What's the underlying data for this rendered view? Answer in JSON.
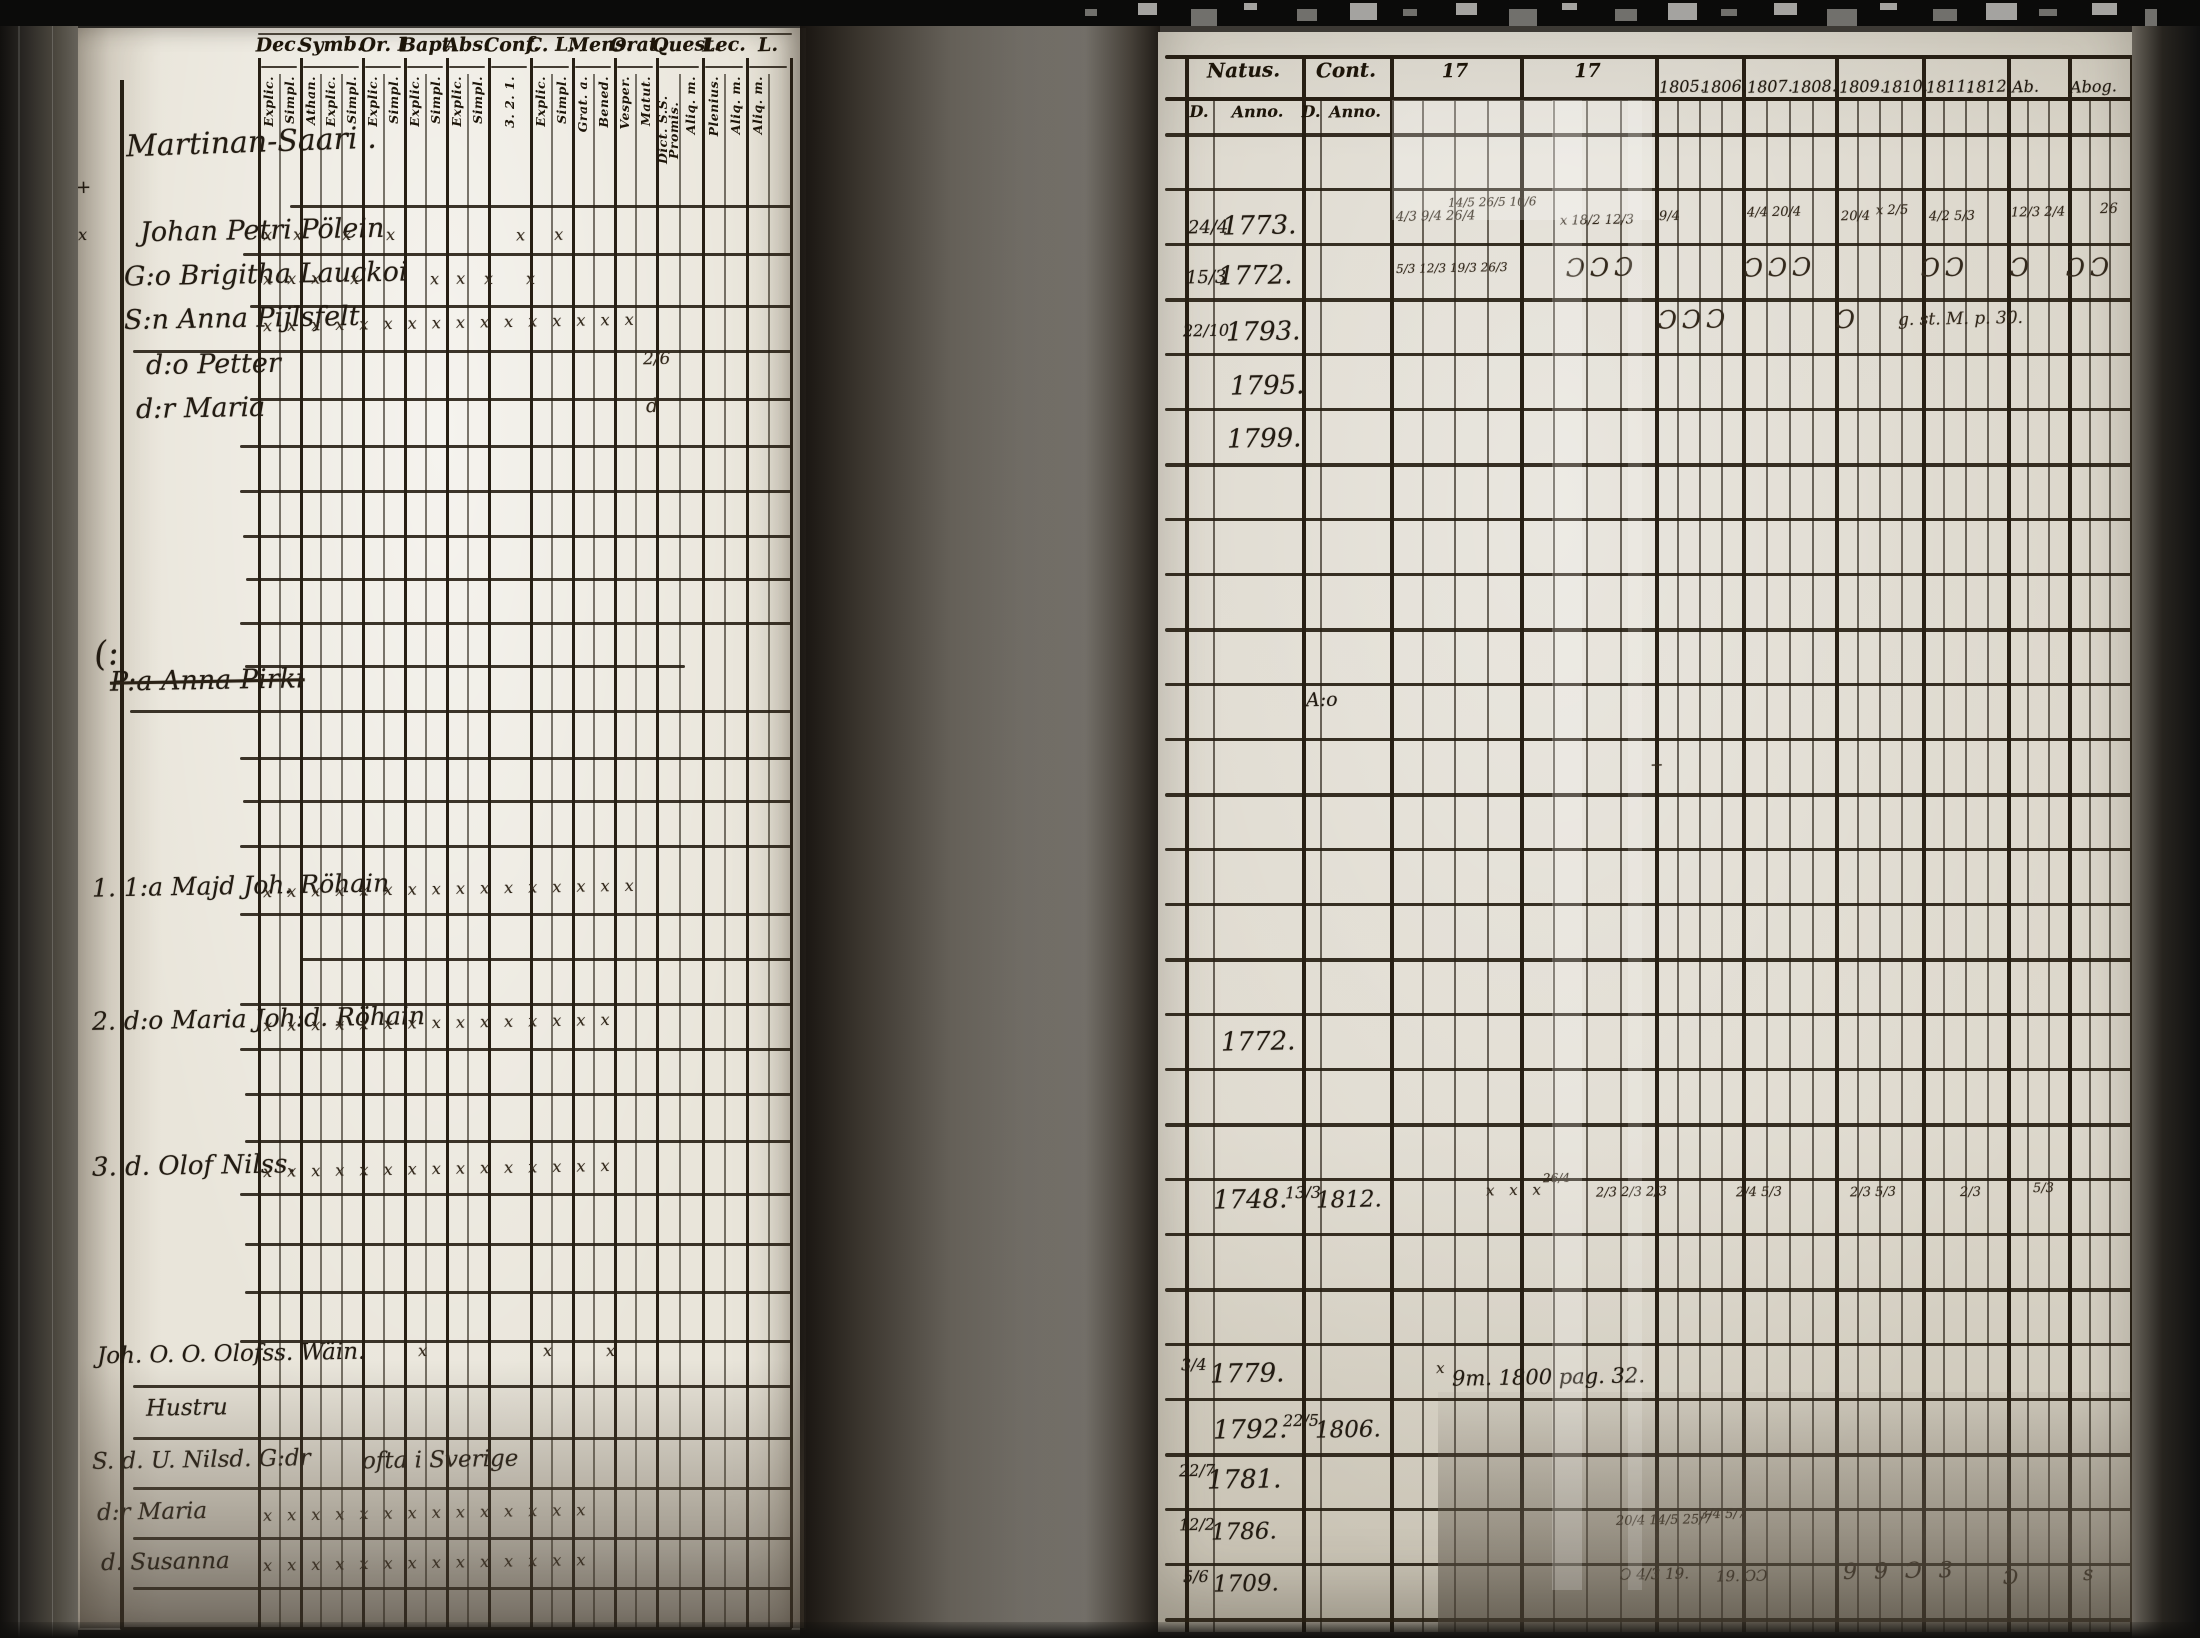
{
  "page_number": "72",
  "left_page": {
    "section_title": "Martinan-Saari .",
    "header_groups": [
      {
        "label": "Dec.",
        "subs": [
          "Explic.",
          "Simpl."
        ]
      },
      {
        "label": "Symb.",
        "subs": [
          "Athan.",
          "Explic.",
          "Simpl."
        ]
      },
      {
        "label": "Or. I",
        "subs": [
          "Explic.",
          "Simpl."
        ]
      },
      {
        "label": "Bapt.",
        "subs": [
          "Explic.",
          "Simpl."
        ]
      },
      {
        "label": "Abs.",
        "subs": [
          "Explic.",
          "Simpl."
        ]
      },
      {
        "label": "Conf.",
        "subs": [
          "3. 2. 1."
        ]
      },
      {
        "label": "C. L.",
        "subs": [
          "Explic.",
          "Simpl."
        ]
      },
      {
        "label": "Mens.",
        "subs": [
          "Grat. a.",
          "Bened."
        ]
      },
      {
        "label": "Orat.",
        "subs": [
          "Vesper.",
          "Matut."
        ]
      },
      {
        "label": "Quest.",
        "subs": [
          "Dict. S.S. Promis.",
          "Aliq. m."
        ]
      },
      {
        "label": "Lec.",
        "subs": [
          "Plenius.",
          "Aliq. m."
        ]
      },
      {
        "label": "L.",
        "subs": [
          "Aliq. m.",
          ""
        ]
      }
    ],
    "entries": [
      {
        "x": 140,
        "y": 216,
        "t": "Johan Petri Pölein",
        "fs": 27
      },
      {
        "x": 124,
        "y": 260,
        "t": "G:o Brigitha Lauckoi",
        "fs": 27
      },
      {
        "x": 124,
        "y": 304,
        "t": "S:n Anna Pijlsfelt",
        "fs": 27
      },
      {
        "x": 146,
        "y": 350,
        "t": "d:o Petter",
        "fs": 27
      },
      {
        "x": 136,
        "y": 394,
        "t": "d:r Maria",
        "fs": 27
      },
      {
        "x": 94,
        "y": 636,
        "t": "(:",
        "fs": 34,
        "r": -6
      },
      {
        "x": 110,
        "y": 666,
        "t": "P:a Anna Pirki",
        "fs": 27,
        "strike": true
      },
      {
        "x": 92,
        "y": 872,
        "t": "1. 1:a Majd Joh. Röhain",
        "fs": 25
      },
      {
        "x": 92,
        "y": 1005,
        "t": "2. d:o Maria Joh:d. Röhain",
        "fs": 25
      },
      {
        "x": 92,
        "y": 1152,
        "t": "3. d. Olof Nilss.",
        "fs": 26
      },
      {
        "x": 97,
        "y": 1342,
        "t": "Joh. O. O. Olofss. Wäin.",
        "fs": 23
      },
      {
        "x": 146,
        "y": 1396,
        "t": "Hustru",
        "fs": 23
      },
      {
        "x": 92,
        "y": 1448,
        "t": "S. d. U. Nilsd. G:dr",
        "fs": 23
      },
      {
        "x": 362,
        "y": 1448,
        "t": "ofta i Sverige",
        "fs": 23
      },
      {
        "x": 97,
        "y": 1500,
        "t": "d:r Maria",
        "fs": 23
      },
      {
        "x": 101,
        "y": 1550,
        "t": "d. Susanna",
        "fs": 23
      },
      {
        "x": 76,
        "y": 178,
        "t": "+",
        "fs": 18
      },
      {
        "x": 78,
        "y": 226,
        "t": "x",
        "fs": 16
      }
    ],
    "marks": [
      {
        "x": 263,
        "y": 226,
        "t": "x x",
        "ls": 8
      },
      {
        "x": 342,
        "y": 226,
        "t": "x"
      },
      {
        "x": 386,
        "y": 226,
        "t": "x"
      },
      {
        "x": 516,
        "y": 226,
        "t": "x x",
        "ls": 12
      },
      {
        "x": 263,
        "y": 270,
        "t": "x x x",
        "ls": 5
      },
      {
        "x": 350,
        "y": 270,
        "t": "x"
      },
      {
        "x": 430,
        "y": 270,
        "t": "x x",
        "ls": 6
      },
      {
        "x": 484,
        "y": 270,
        "t": "x"
      },
      {
        "x": 526,
        "y": 270,
        "t": "x"
      },
      {
        "x": 263,
        "y": 314,
        "t": "x x x x x x x x x x x x x x x x",
        "ls": 5
      },
      {
        "x": 643,
        "y": 350,
        "t": "2/6",
        "fs": 17
      },
      {
        "x": 646,
        "y": 396,
        "t": "d",
        "fs": 19
      },
      {
        "x": 263,
        "y": 880,
        "t": "x x x x x x x x x x x x x x x x",
        "ls": 5
      },
      {
        "x": 263,
        "y": 1014,
        "t": "x x x x x x x x x x x x x x x",
        "ls": 5
      },
      {
        "x": 263,
        "y": 1160,
        "t": "x x x x x x x x x x x x x x x",
        "ls": 5
      },
      {
        "x": 418,
        "y": 1342,
        "t": "x"
      },
      {
        "x": 543,
        "y": 1342,
        "t": "x"
      },
      {
        "x": 606,
        "y": 1342,
        "t": "x"
      },
      {
        "x": 263,
        "y": 1504,
        "t": "x x x x x x x x x x x x x x",
        "ls": 5
      },
      {
        "x": 263,
        "y": 1554,
        "t": "x x x x x x x x x x x x x x",
        "ls": 5
      }
    ]
  },
  "right_page": {
    "header": {
      "natus": "Natus.",
      "cont": "Cont.",
      "c17a": "17",
      "c17b": "17",
      "d1": "D.",
      "anno1": "Anno.",
      "d2": "D.",
      "anno2": "Anno.",
      "year_labels": [
        {
          "x": 1659,
          "t": "1805."
        },
        {
          "x": 1701,
          "t": "1806."
        },
        {
          "x": 1747,
          "t": "1807."
        },
        {
          "x": 1791,
          "t": "1808."
        },
        {
          "x": 1839,
          "t": "1809."
        },
        {
          "x": 1882,
          "t": "1810."
        },
        {
          "x": 1926,
          "t": "1811."
        },
        {
          "x": 1966,
          "t": "1812."
        },
        {
          "x": 2012,
          "t": "Ab."
        },
        {
          "x": 2070,
          "t": "Abog."
        }
      ]
    },
    "entries": [
      {
        "x": 1188,
        "y": 218,
        "t": "24/4",
        "fs": 18
      },
      {
        "x": 1222,
        "y": 212,
        "t": "1773.",
        "fs": 26
      },
      {
        "x": 1186,
        "y": 268,
        "t": "15/3",
        "fs": 18
      },
      {
        "x": 1218,
        "y": 262,
        "t": "1772.",
        "fs": 26
      },
      {
        "x": 1183,
        "y": 322,
        "t": "22/10",
        "fs": 16
      },
      {
        "x": 1226,
        "y": 318,
        "t": "1793.",
        "fs": 26
      },
      {
        "x": 1230,
        "y": 372,
        "t": "1795.",
        "fs": 26
      },
      {
        "x": 1227,
        "y": 425,
        "t": "1799.",
        "fs": 26
      },
      {
        "x": 1306,
        "y": 690,
        "t": "A:o",
        "fs": 19
      },
      {
        "x": 1221,
        "y": 1028,
        "t": "1772.",
        "fs": 26
      },
      {
        "x": 1213,
        "y": 1186,
        "t": "1748.",
        "fs": 26
      },
      {
        "x": 1285,
        "y": 1184,
        "t": "13/3",
        "fs": 16
      },
      {
        "x": 1316,
        "y": 1188,
        "t": "1812.",
        "fs": 23
      },
      {
        "x": 1181,
        "y": 1356,
        "t": "3/4",
        "fs": 16
      },
      {
        "x": 1210,
        "y": 1360,
        "t": "1779.",
        "fs": 26
      },
      {
        "x": 1452,
        "y": 1366,
        "t": "9m. 1800 pag. 32.",
        "fs": 21
      },
      {
        "x": 1213,
        "y": 1416,
        "t": "1792.",
        "fs": 26
      },
      {
        "x": 1283,
        "y": 1412,
        "t": "22/5",
        "fs": 16
      },
      {
        "x": 1315,
        "y": 1418,
        "t": "1806.",
        "fs": 23
      },
      {
        "x": 1179,
        "y": 1462,
        "t": "22/7",
        "fs": 16
      },
      {
        "x": 1207,
        "y": 1466,
        "t": "1781.",
        "fs": 26
      },
      {
        "x": 1179,
        "y": 1516,
        "t": "12/2",
        "fs": 16
      },
      {
        "x": 1211,
        "y": 1520,
        "t": "1786.",
        "fs": 23
      },
      {
        "x": 1183,
        "y": 1568,
        "t": "5/6",
        "fs": 16
      },
      {
        "x": 1213,
        "y": 1572,
        "t": "1709.",
        "fs": 23
      }
    ],
    "marks": [
      {
        "x": 1396,
        "y": 210,
        "t": "4/3 9/4 26/4",
        "fs": 13
      },
      {
        "x": 1448,
        "y": 196,
        "t": "14/5 26/5 10/6",
        "fs": 12
      },
      {
        "x": 1560,
        "y": 214,
        "t": "x 18/2 12/3",
        "fs": 13
      },
      {
        "x": 1659,
        "y": 210,
        "t": "9/4",
        "fs": 13
      },
      {
        "x": 1747,
        "y": 206,
        "t": "4/4 20/4",
        "fs": 13
      },
      {
        "x": 1841,
        "y": 210,
        "t": "20/4",
        "fs": 13
      },
      {
        "x": 1876,
        "y": 204,
        "t": "x 2/5",
        "fs": 13
      },
      {
        "x": 1929,
        "y": 210,
        "t": "4/2 5/3",
        "fs": 13
      },
      {
        "x": 2011,
        "y": 206,
        "t": "12/3 2/4",
        "fs": 13
      },
      {
        "x": 2100,
        "y": 202,
        "t": "26",
        "fs": 14
      },
      {
        "x": 1396,
        "y": 262,
        "t": "5/3 12/3 19/3 26/3",
        "fs": 12
      },
      {
        "x": 1566,
        "y": 254,
        "t": "ƆƆƆ",
        "fs": 25,
        "ls": 5
      },
      {
        "x": 1744,
        "y": 254,
        "t": "ƆƆƆ",
        "fs": 25,
        "ls": 5
      },
      {
        "x": 1921,
        "y": 254,
        "t": "ƆƆ",
        "fs": 25,
        "ls": 5
      },
      {
        "x": 2010,
        "y": 254,
        "t": "Ɔ",
        "fs": 25
      },
      {
        "x": 2066,
        "y": 254,
        "t": "ƆƆ",
        "fs": 25,
        "ls": 5
      },
      {
        "x": 1658,
        "y": 306,
        "t": "ƆƆƆ",
        "fs": 25,
        "ls": 5
      },
      {
        "x": 1836,
        "y": 306,
        "t": "Ɔ",
        "fs": 25
      },
      {
        "x": 1898,
        "y": 310,
        "t": "g. st. M. p. 30.",
        "fs": 17
      },
      {
        "x": 1650,
        "y": 756,
        "t": "+",
        "fs": 16
      },
      {
        "x": 1486,
        "y": 1182,
        "t": "x x x",
        "fs": 15,
        "ls": 5
      },
      {
        "x": 1543,
        "y": 1172,
        "t": "26/4",
        "fs": 12
      },
      {
        "x": 1596,
        "y": 1186,
        "t": "2/3 2/3 2/3",
        "fs": 13
      },
      {
        "x": 1736,
        "y": 1186,
        "t": "2/4 5/3",
        "fs": 13
      },
      {
        "x": 1850,
        "y": 1186,
        "t": "2/3 5/3",
        "fs": 13
      },
      {
        "x": 1960,
        "y": 1186,
        "t": "2/3",
        "fs": 13
      },
      {
        "x": 2033,
        "y": 1182,
        "t": "5/3",
        "fs": 13
      },
      {
        "x": 1436,
        "y": 1360,
        "t": "x",
        "fs": 15
      },
      {
        "x": 1616,
        "y": 1514,
        "t": "20/4 14/5 25/7",
        "fs": 13
      },
      {
        "x": 1700,
        "y": 1508,
        "t": "3/4 5/7",
        "fs": 13
      },
      {
        "x": 1620,
        "y": 1566,
        "t": "Ɔ 4/3 19.",
        "fs": 15
      },
      {
        "x": 1716,
        "y": 1568,
        "t": "19. ƆƆ",
        "fs": 15
      },
      {
        "x": 1843,
        "y": 1560,
        "t": "9 9 Ɔ 3",
        "fs": 22,
        "ls": 5
      },
      {
        "x": 2003,
        "y": 1566,
        "t": "Ɔ",
        "fs": 20
      },
      {
        "x": 2083,
        "y": 1562,
        "t": "s",
        "fs": 20
      }
    ]
  }
}
